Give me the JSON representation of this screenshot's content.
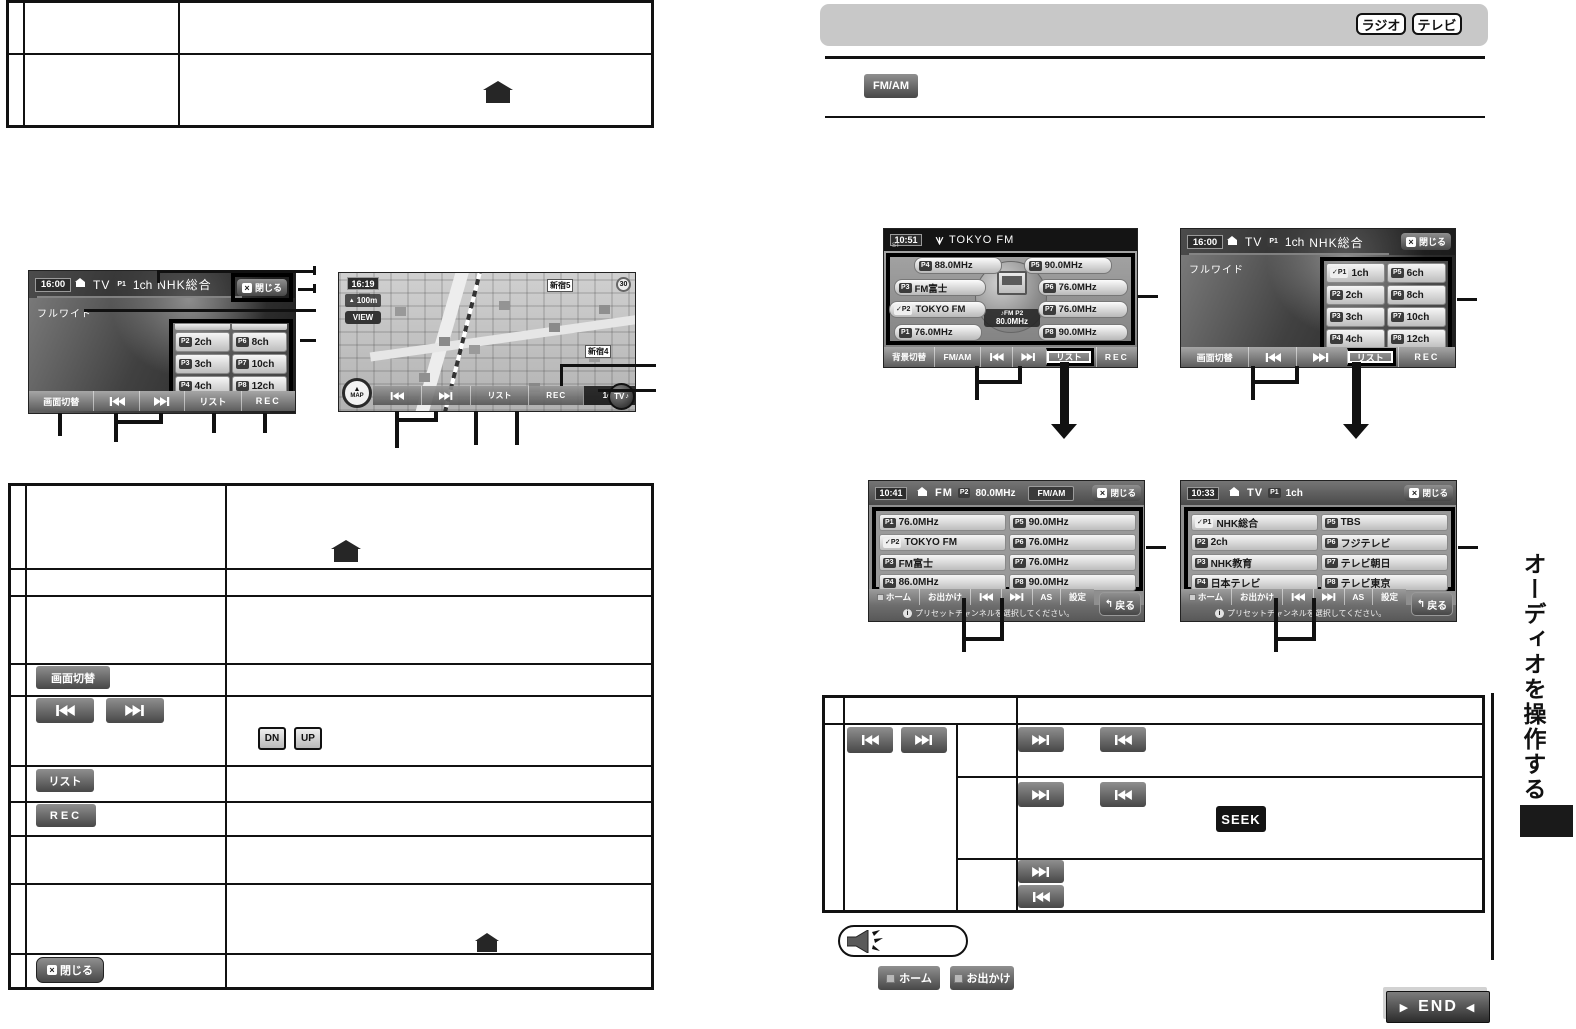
{
  "page": {
    "vertical_title": "オーディオを操作する",
    "end_label": "END"
  },
  "header": {
    "radio_badge": "ラジオ",
    "tv_badge": "テレビ",
    "fmam_button": "FM/AM"
  },
  "left_table": {
    "screen_switch": "画面切替",
    "dn": "DN",
    "up": "UP",
    "list": "リスト",
    "rec": "REC",
    "close": "閉じる"
  },
  "fig_tv": {
    "time": "16:00",
    "source": "TV",
    "preset_tag": "P1",
    "channel": "1ch",
    "station": "NHK総合",
    "close": "閉じる",
    "wide": "フルワイド",
    "bar": {
      "screen_switch": "画面切替",
      "list": "リスト",
      "rec": "REC"
    },
    "ch": [
      {
        "tag": "P2",
        "label": "2ch"
      },
      {
        "tag": "P6",
        "label": "8ch"
      },
      {
        "tag": "P3",
        "label": "3ch"
      },
      {
        "tag": "P7",
        "label": "10ch"
      },
      {
        "tag": "P4",
        "label": "4ch"
      },
      {
        "tag": "P8",
        "label": "12ch"
      }
    ]
  },
  "fig_map": {
    "time": "16:19",
    "scale": "100m",
    "view": "VIEW",
    "compass": "MAP",
    "area_label_1": "新宿5",
    "area_label_2": "新宿4",
    "speed_sign": "30",
    "bar": {
      "list": "リスト",
      "rec": "REC",
      "ch": "1ch",
      "tv": "TV"
    }
  },
  "fig_radio": {
    "time": "10:51",
    "stereo": "ST",
    "station": "TOKYO FM",
    "center_band": "FM P2",
    "center_freq": "80.0MHz",
    "bar": {
      "bg_switch": "背景切替",
      "fmam": "FM/AM",
      "list": "リスト",
      "rec": "REC"
    },
    "presets": [
      {
        "tag": "P4",
        "label": "88.0MHz"
      },
      {
        "tag": "P5",
        "label": "90.0MHz"
      },
      {
        "tag": "P3",
        "label": "FM富士"
      },
      {
        "tag": "P6",
        "label": "76.0MHz"
      },
      {
        "tag": "P2",
        "label": "TOKYO FM"
      },
      {
        "tag": "P7",
        "label": "76.0MHz"
      },
      {
        "tag": "P1",
        "label": "76.0MHz"
      },
      {
        "tag": "P8",
        "label": "90.0MHz"
      }
    ]
  },
  "fig_tv2": {
    "time": "16:00",
    "source": "TV",
    "preset_tag": "P1",
    "channel": "1ch",
    "station": "NHK総合",
    "close": "閉じる",
    "wide": "フルワイド",
    "bar": {
      "screen_switch": "画面切替",
      "list": "リスト",
      "rec": "REC"
    },
    "ch": [
      {
        "tag": "P1",
        "label": "1ch"
      },
      {
        "tag": "P5",
        "label": "6ch"
      },
      {
        "tag": "P2",
        "label": "2ch"
      },
      {
        "tag": "P6",
        "label": "8ch"
      },
      {
        "tag": "P3",
        "label": "3ch"
      },
      {
        "tag": "P7",
        "label": "10ch"
      },
      {
        "tag": "P4",
        "label": "4ch"
      },
      {
        "tag": "P8",
        "label": "12ch"
      }
    ]
  },
  "fig_fm_list": {
    "time": "10:41",
    "source": "FM",
    "preset_tag": "P2",
    "freq": "80.0MHz",
    "fmam": "FM/AM",
    "close": "閉じる",
    "bar": {
      "home": "ホーム",
      "odekake": "お出かけ",
      "as": "AS",
      "settings": "設定",
      "back": "戻る"
    },
    "message": "プリセットチャンネルを選択してください。",
    "items": [
      {
        "tag": "P1",
        "label": "76.0MHz"
      },
      {
        "tag": "P5",
        "label": "90.0MHz"
      },
      {
        "tag": "P2",
        "label": "TOKYO FM"
      },
      {
        "tag": "P6",
        "label": "76.0MHz"
      },
      {
        "tag": "P3",
        "label": "FM富士"
      },
      {
        "tag": "P7",
        "label": "76.0MHz"
      },
      {
        "tag": "P4",
        "label": "86.0MHz"
      },
      {
        "tag": "P8",
        "label": "90.0MHz"
      }
    ]
  },
  "fig_tv_list": {
    "time": "10:33",
    "source": "TV",
    "preset_tag": "P1",
    "channel": "1ch",
    "close": "閉じる",
    "bar": {
      "home": "ホーム",
      "odekake": "お出かけ",
      "as": "AS",
      "settings": "設定",
      "back": "戻る"
    },
    "message": "プリセットチャンネルを選択してください。",
    "items": [
      {
        "tag": "P1",
        "label": "NHK総合"
      },
      {
        "tag": "P5",
        "label": "TBS"
      },
      {
        "tag": "P2",
        "label": "2ch"
      },
      {
        "tag": "P6",
        "label": "フジテレビ"
      },
      {
        "tag": "P3",
        "label": "NHK教育"
      },
      {
        "tag": "P7",
        "label": "テレビ朝日"
      },
      {
        "tag": "P4",
        "label": "日本テレビ"
      },
      {
        "tag": "P8",
        "label": "テレビ東京"
      }
    ]
  },
  "right_table": {
    "seek_badge": "SEEK"
  },
  "footer": {
    "home": "ホーム",
    "odekake": "お出かけ"
  }
}
